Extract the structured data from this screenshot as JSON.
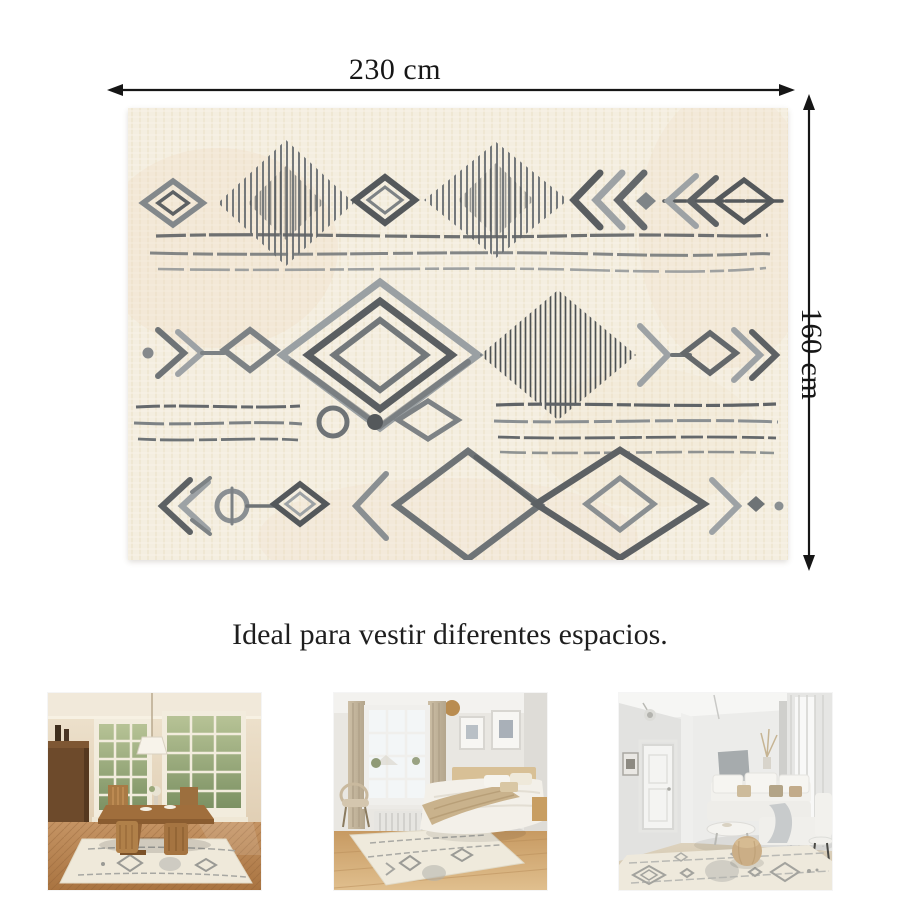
{
  "dimensions": {
    "width_label": "230 cm",
    "height_label": "160 cm"
  },
  "caption": "Ideal para vestir diferentes espacios.",
  "rug": {
    "style": "berber-geometric-pattern",
    "base_color": "#f4eee0",
    "pattern_dark_color": "#54585b",
    "pattern_light_color": "#9da2a5"
  },
  "annotation": {
    "line_color": "#161616",
    "text_color": "#1b1b1b"
  },
  "gallery": [
    {
      "name": "dining-room-photo"
    },
    {
      "name": "bedroom-photo"
    },
    {
      "name": "living-room-photo"
    }
  ]
}
